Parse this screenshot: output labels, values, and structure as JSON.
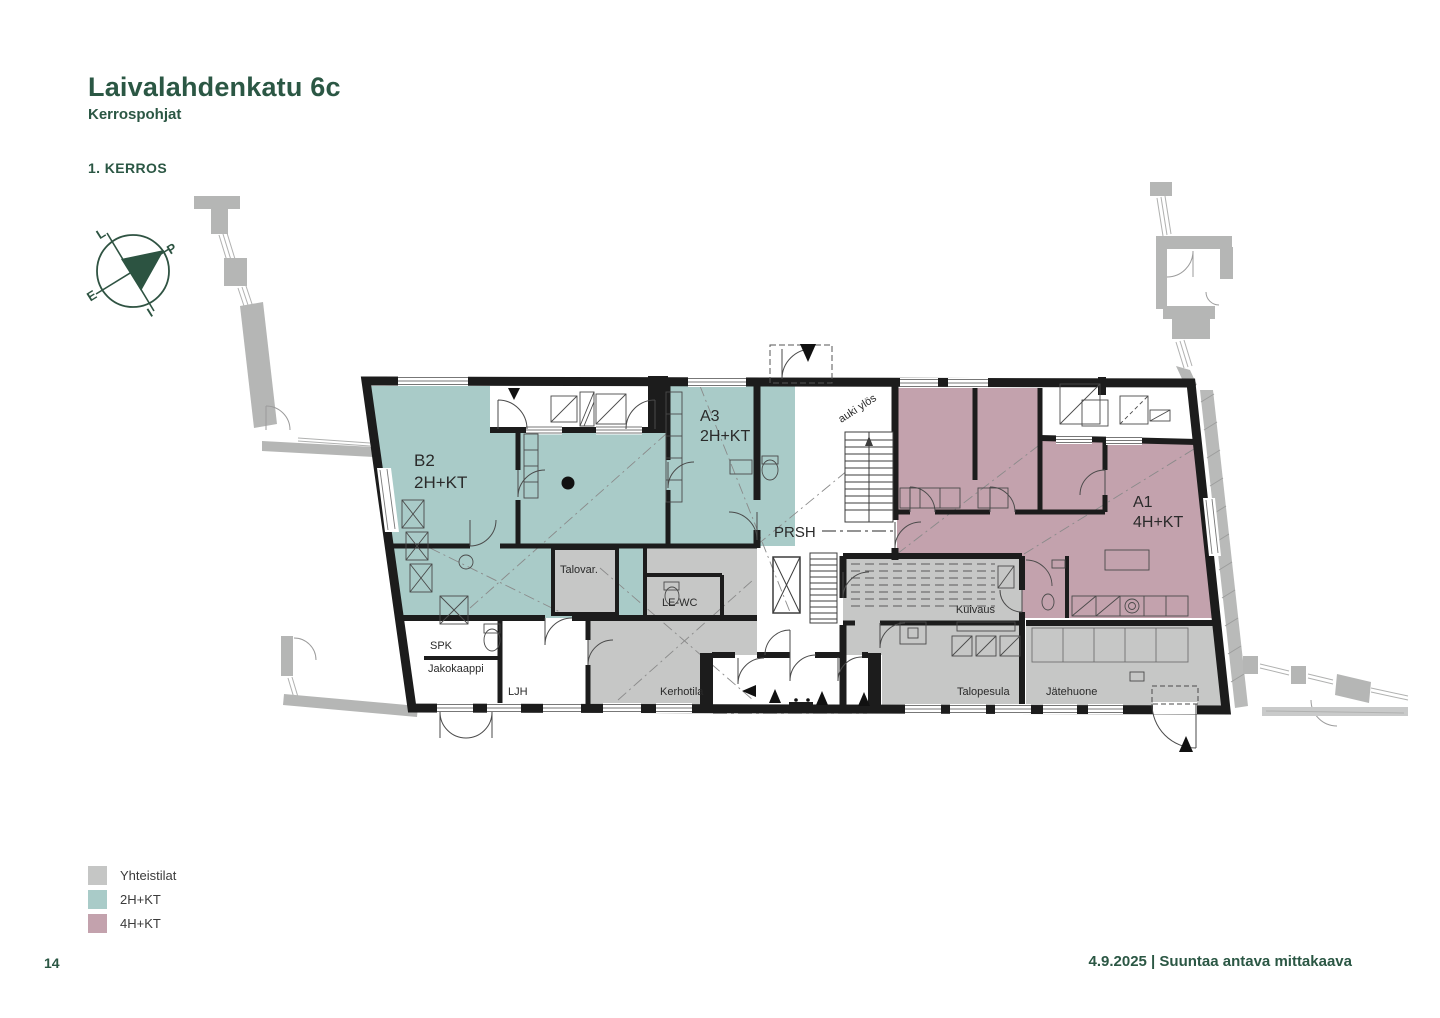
{
  "header": {
    "title": "Laivalahdenkatu 6c",
    "subtitle": "Kerrospohjat",
    "floor_label": "1. KERROS"
  },
  "compass": {
    "north": "P",
    "east": "I",
    "south": "E",
    "west": "L"
  },
  "plan": {
    "apartments": [
      {
        "id": "B2",
        "type": "2H+KT",
        "color": "#a9cbc8"
      },
      {
        "id": "A3",
        "type": "2H+KT",
        "color": "#a9cbc8"
      },
      {
        "id": "A1",
        "type": "4H+KT",
        "color": "#c3a2ad"
      }
    ],
    "rooms": {
      "prsh": "PRSH",
      "talovar": "Talovar.",
      "lewc": "LE-WC",
      "spk": "SPK",
      "jakokaappi": "Jakokaappi",
      "ljh": "LJH",
      "kerhotila": "Kerhotila",
      "kuivaus": "Kuivaus",
      "talopesula": "Talopesula",
      "jatehuone": "Jätehuone"
    },
    "annotations": {
      "stair_note": "auki ylös"
    },
    "colors": {
      "wall": "#1c1c1c",
      "common_gray": "#c6c7c6",
      "neighbor_gray": "#b5b6b5",
      "accent_green": "#2b5744"
    }
  },
  "legend": {
    "items": [
      {
        "label": "Yhteistilat",
        "color": "#c5c6c5"
      },
      {
        "label": "2H+KT",
        "color": "#a9cbc8"
      },
      {
        "label": "4H+KT",
        "color": "#c3a2ad"
      }
    ]
  },
  "footer": {
    "page_number": "14",
    "note": "4.9.2025 | Suuntaa antava mittakaava"
  }
}
